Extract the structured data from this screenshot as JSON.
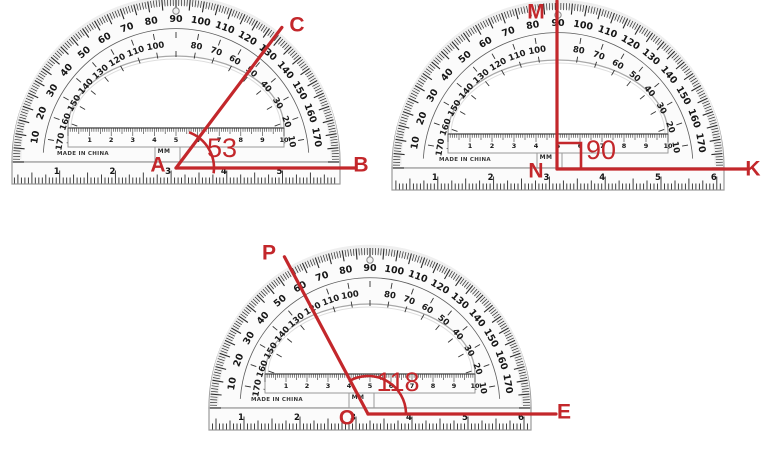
{
  "page": {
    "background": "#ffffff"
  },
  "colors": {
    "red": "#c3272b",
    "tick": "#2b2b2b",
    "body": "#fbfbfb",
    "border": "#9a9a9a",
    "cutout_edge": "#a8a8a8"
  },
  "protractor": {
    "outer_scale": [
      10,
      20,
      30,
      40,
      50,
      60,
      70,
      80,
      90,
      100,
      110,
      120,
      130,
      140,
      150,
      160,
      170
    ],
    "inner_scale": [
      170,
      160,
      150,
      140,
      130,
      120,
      110,
      100,
      80,
      70,
      60,
      50,
      40,
      30,
      20,
      10
    ],
    "cm_scale": [
      1,
      2,
      3,
      4,
      5,
      6,
      7,
      8,
      9,
      10
    ],
    "inch_scale": [
      1,
      2,
      3,
      4,
      5,
      6
    ],
    "unit_label": "MM",
    "made_in": "MADE IN CHINA"
  },
  "diagrams": [
    {
      "id": "angle-ABC",
      "protractor": {
        "cx": 176,
        "baseline_y": 162,
        "radius": 164,
        "inch_x0": 4,
        "inch_spacing": 55.7
      },
      "vertex": {
        "x": 176,
        "y": 168
      },
      "angle_deg": 53,
      "angle_label": "53",
      "base_length": 180,
      "ray_length": 176,
      "labels": {
        "vertex": "A",
        "base_end": "B",
        "ray_end": "C"
      },
      "label_pos": {
        "vertex": [
          158,
          164
        ],
        "base_end": [
          361,
          164
        ],
        "ray_end": [
          297,
          24
        ],
        "angle": [
          222,
          148
        ]
      },
      "arc": {
        "r": 38,
        "from": 70,
        "to": -8
      },
      "right_angle_marker": null
    },
    {
      "id": "angle-MNK",
      "protractor": {
        "cx": 558,
        "baseline_y": 168,
        "radius": 166,
        "inch_x0": 382,
        "inch_spacing": 55.8
      },
      "vertex": {
        "x": 557,
        "y": 169
      },
      "angle_deg": 90,
      "angle_label": "90",
      "base_length": 190,
      "ray_length": 168,
      "labels": {
        "vertex": "N",
        "base_end": "K",
        "ray_end": "M"
      },
      "label_pos": {
        "vertex": [
          536,
          170
        ],
        "base_end": [
          753,
          168
        ],
        "ray_end": [
          536,
          11
        ],
        "angle": [
          601,
          150
        ]
      },
      "arc": null,
      "right_angle_marker": {
        "width": 24,
        "height": 26
      }
    },
    {
      "id": "angle-POE",
      "protractor": {
        "cx": 370,
        "baseline_y": 408,
        "radius": 161,
        "inch_x0": 188,
        "inch_spacing": 56
      },
      "vertex": {
        "x": 368,
        "y": 414
      },
      "angle_deg": 118,
      "angle_label": "118",
      "base_length": 188,
      "ray_length": 178,
      "labels": {
        "vertex": "O",
        "base_end": "E",
        "ray_end": "P"
      },
      "label_pos": {
        "vertex": [
          347,
          417
        ],
        "base_end": [
          564,
          411
        ],
        "ray_end": [
          269,
          252
        ],
        "angle": [
          398,
          382
        ]
      },
      "arc": {
        "r": 38,
        "from": 120,
        "to": 2
      },
      "right_angle_marker": null
    }
  ]
}
